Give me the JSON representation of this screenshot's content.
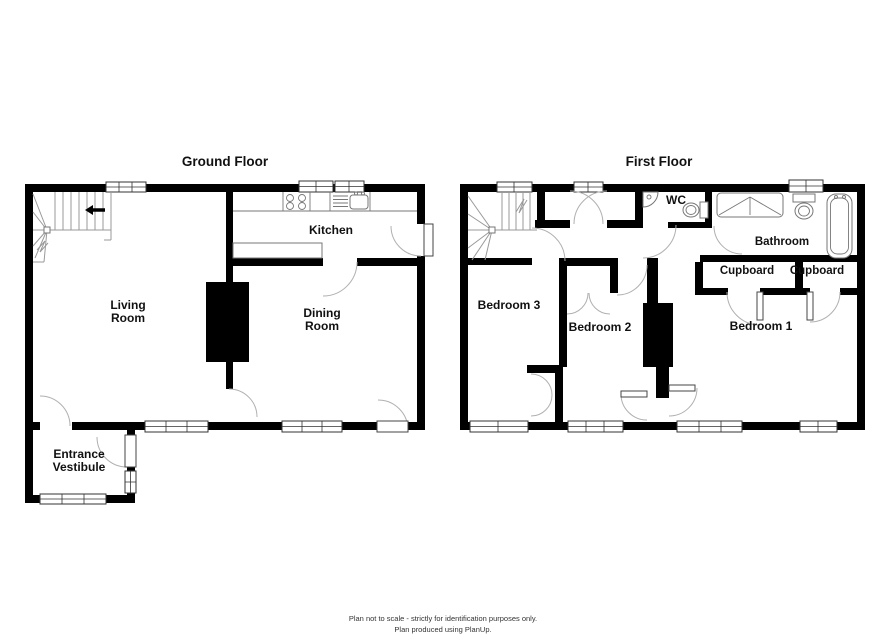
{
  "titles": {
    "ground": "Ground Floor",
    "first": "First Floor"
  },
  "gf": {
    "living1": "Living",
    "living2": "Room",
    "dining1": "Dining",
    "dining2": "Room",
    "kitchen": "Kitchen",
    "entrance1": "Entrance",
    "entrance2": "Vestibule"
  },
  "ff": {
    "bed1": "Bedroom 1",
    "bed2": "Bedroom 2",
    "bed3": "Bedroom 3",
    "wc": "WC",
    "bathroom": "Bathroom",
    "cupboard_l": "Cupboard",
    "cupboard_r": "Cupboard"
  },
  "footer": {
    "line1": "Plan not to scale - strictly for identification purposes only.",
    "line2": "Plan produced using PlanUp."
  },
  "colors": {
    "wall": "#000000",
    "door_arc": "#b0b0b0",
    "fixture": "#777777",
    "stairs": "#999999",
    "background": "#ffffff",
    "text": "#111111"
  },
  "icons": [
    "stairs-icon",
    "up-arrow-icon",
    "hob-icon",
    "drainer-icon",
    "sink-icon",
    "worktop-icon",
    "chimney-breast",
    "window",
    "door-leaf",
    "door-arc",
    "wc-basin-icon",
    "wc-toilet-icon",
    "shower-icon",
    "toilet-icon",
    "bath-icon"
  ]
}
